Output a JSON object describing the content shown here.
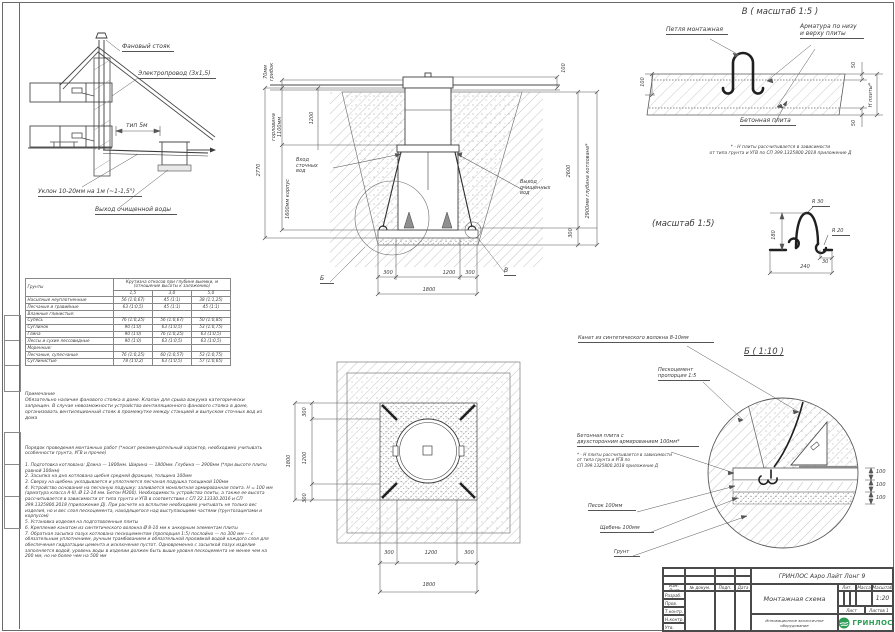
{
  "colors": {
    "logo_green": "#2e9e57",
    "line": "#3f3f3f",
    "hatch": "#c3c3c3"
  },
  "house": {
    "vent": "Фановый стояк",
    "wire": "Электропровод (3х1,5)",
    "pipe": "тип 5м",
    "slope": "Уклон 10-20мм на 1м (~1-1,5°)",
    "outlet": "Выход очищенной воды"
  },
  "section": {
    "inlet": "Вход\nсточных\nвод",
    "outlet": "Выход\nочищенных\nвод",
    "callout_b": "Б",
    "callout_v": "В",
    "dim_grib": "70мм\nгрибок",
    "dim_neck": "горловина\n1100мм",
    "dim_total": "2770",
    "dim_body": "1600мм корпус",
    "dim_1200": "1200",
    "dim_100": "100",
    "dim_2600": "2600",
    "dim_300r": "300",
    "dim_depth": "2900мм глубина котлована*",
    "dim_b300l": "300",
    "dim_b1200": "1200",
    "dim_b300r": "300",
    "dim_b1800": "1800"
  },
  "plan": {
    "l300a": "300",
    "l1200": "1200",
    "l300b": "300",
    "l1800": "1800",
    "b300a": "300",
    "b1200": "1200",
    "b300b": "300",
    "b1800": "1800"
  },
  "detail_v": {
    "title": "В ( масштаб 1:5 )",
    "loop": "Петля монтажная",
    "rebar": "Арматура по низу\nи верху плиты",
    "slab": "Бетонная плита",
    "dim100": "100",
    "dim50a": "50",
    "dim50b": "50",
    "dimH": "Н плиты*",
    "note": "* - Н плиты рассчитывается в зависимости\nот типа грунта и УГВ по СП 399.1325800.2018 приложение Д"
  },
  "detail_loop": {
    "title": "(масштаб 1:5)",
    "r30": "R 30",
    "r20": "R 20",
    "d180": "180",
    "d30": "30",
    "d240": "240"
  },
  "detail_b": {
    "rope": "Канат из синтетического волокна 8-10мм",
    "title": "Б ( 1:10 )",
    "sandcement": "Пескоцемент\nпропорция 1:5",
    "slab": "Бетонная плита с\nдвухсторонним армированием 100мм*",
    "note": "* - Н плиты рассчитывается в зависимости\nот типа грунта и УГВ по\nСП 399.1325800.2018 приложение Д",
    "sand": "Песок 100мм",
    "gravel": "Щебень 100мм",
    "soil": "Грунт",
    "d100a": "100",
    "d100b": "100",
    "d100c": "100"
  },
  "soil_table": {
    "col_soil": "Грунты",
    "col_main": "Крутизна откосов при глубине выемки, м (отношение высоты к заложению)",
    "depths": [
      "1,5",
      "3,0",
      "5,0"
    ],
    "rows": [
      [
        "Насыпные неуплотненные",
        "56 (1:0,67)",
        "45 (1:1)",
        "38 (1:1,25)"
      ],
      [
        "Песчаные и гравийные",
        "63 (1:0,5)",
        "45 (1:1)",
        "45 (1:1)"
      ],
      [
        "Влажные глинистые:",
        "",
        "",
        ""
      ],
      [
        "Супесь",
        "76 (1:0,25)",
        "56 (1:0,67)",
        "50 (1:0,85)"
      ],
      [
        "Суглинок",
        "90 (1:0)",
        "63 (1:0,5)",
        "53 (1:0,75)"
      ],
      [
        "Глина",
        "90 (1:0)",
        "76 (1:0,25)",
        "63 (1:0,5)"
      ],
      [
        "Лессы и сухие лессовидные",
        "90 (1:0)",
        "63 (1:0,5)",
        "63 (1:0,5)"
      ],
      [
        "Моренные:",
        "",
        "",
        ""
      ],
      [
        "Песчаные, супесчаные",
        "76 (1:0,25)",
        "60 (1:0,57)",
        "53 (1:0,75)"
      ],
      [
        "Суглинистые",
        "78 (1:0,2)",
        "63 (1:0,5)",
        "57 (1:0,65)"
      ]
    ]
  },
  "notes": {
    "title": "Примечание",
    "body": "Обязательно наличие фанового стояка в доме. Клапан для срыва вакуума категорически запрещен. В случае невозможности устройства вентиляционного фанового стояка в доме, организовать вентиляционный стояк в промежутке между станцией и выпуском сточных вод из дома"
  },
  "montage": {
    "title": "Порядок проведения монтажных работ (*носит рекомендательный характер, необходимо учитывать особенности грунта, УГВ и прочее)",
    "steps": "1. Подготовка котлована: Длина — 1800мм. Ширина — 1800мм. Глубина — 2900мм (*при высоте плиты равной 100мм)\n2. Засыпка на дно котлована щебня средней фракции, толщина 100мм\n3. Сверху на щебень укладывается и уплотняется песчаная подушка толщиной 100мм\n4. Устройство основания на песчаную подушку: заливается монолитная армированная плита. Н = 100 мм (арматура класса А-III, Ø 12-14 мм. Бетон М300). Необходимость устройства плиты, а также ее высота рассчитывается в зависимости от типа грунта и УГВ в соответствии с СП 22.13330.2016 и СП 399.1325800.2018 (приложение Д). При расчете на всплытие необходимо учитывать не только вес изделия, но и вес слоя пескоцемента, находящегося над выступающими частями (грунтозацепами и корпусом)\n5. Установка изделия на подготовленные плиты\n6. Крепление канатом из синтетического волокна Ø 8-10 мм к анкерным элементам плиты\n7. Обратная засыпка пазух котлована пескоцементом (пропорция 1:5) послойно — по 300 мм — с обязательным уплотнением, ручным трамбованием и обязательной проливкой водой каждого слоя для обеспечения гидратации цемента и исключения пустот. Одновременно с засыпкой пазух изделие заполняется водой, уровень воды в изделии должен быть выше уровня пескоцемента не менее чем на 200 мм, но не более чем на 500 мм"
  },
  "title_block": {
    "product": "ГРИНЛОС Аэро Лайт Лонг 9",
    "doc_name": "Монтажная схема",
    "tagline": "Инновационное экологичное оборудование",
    "col_izm": "Изм. Лист",
    "col_doc": "№ докум.",
    "col_sign": "Подп.",
    "col_date": "Дата",
    "row_dev": "Разраб.",
    "row_check": "Пров.",
    "row_tcontr": "Т.контр.",
    "row_ncontr": "Н.контр.",
    "row_appr": "Утв.",
    "lit": "Лит.",
    "mass": "Масса",
    "scale_label": "Масштаб",
    "scale": "1:20",
    "sheet": "Лист",
    "sheets": "Листов 1",
    "logo": "ГРИНЛОС"
  }
}
